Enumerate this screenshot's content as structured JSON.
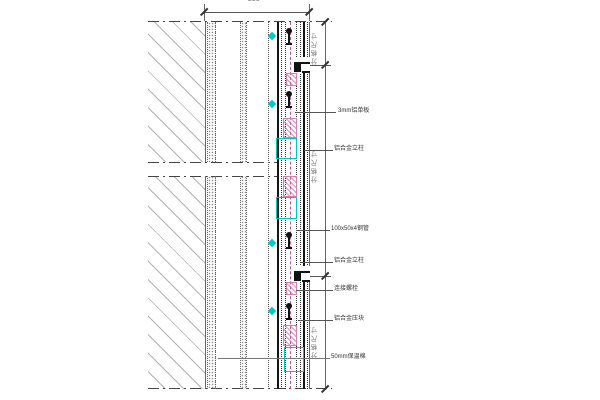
{
  "dimensions": {
    "top_width_label": "250",
    "grid_labels": [
      "分格尺寸",
      "分格尺寸",
      "分格尺寸"
    ]
  },
  "callouts": [
    {
      "text": "3mm铝单板"
    },
    {
      "text": "铝合金立柱"
    },
    {
      "text": "100x50x4钢管"
    },
    {
      "text": "铝合金立柱"
    },
    {
      "text": "连接螺栓"
    },
    {
      "text": "铝合金压块"
    },
    {
      "text": "50mm保温棉"
    }
  ],
  "colors": {
    "line": "#141414",
    "hatch_gray": "#b3b3b3",
    "accent_cyan": "#00c8c8",
    "accent_magenta": "#c050a0",
    "pink_hatch": "#d66aa8",
    "dim_text": "#777777"
  }
}
